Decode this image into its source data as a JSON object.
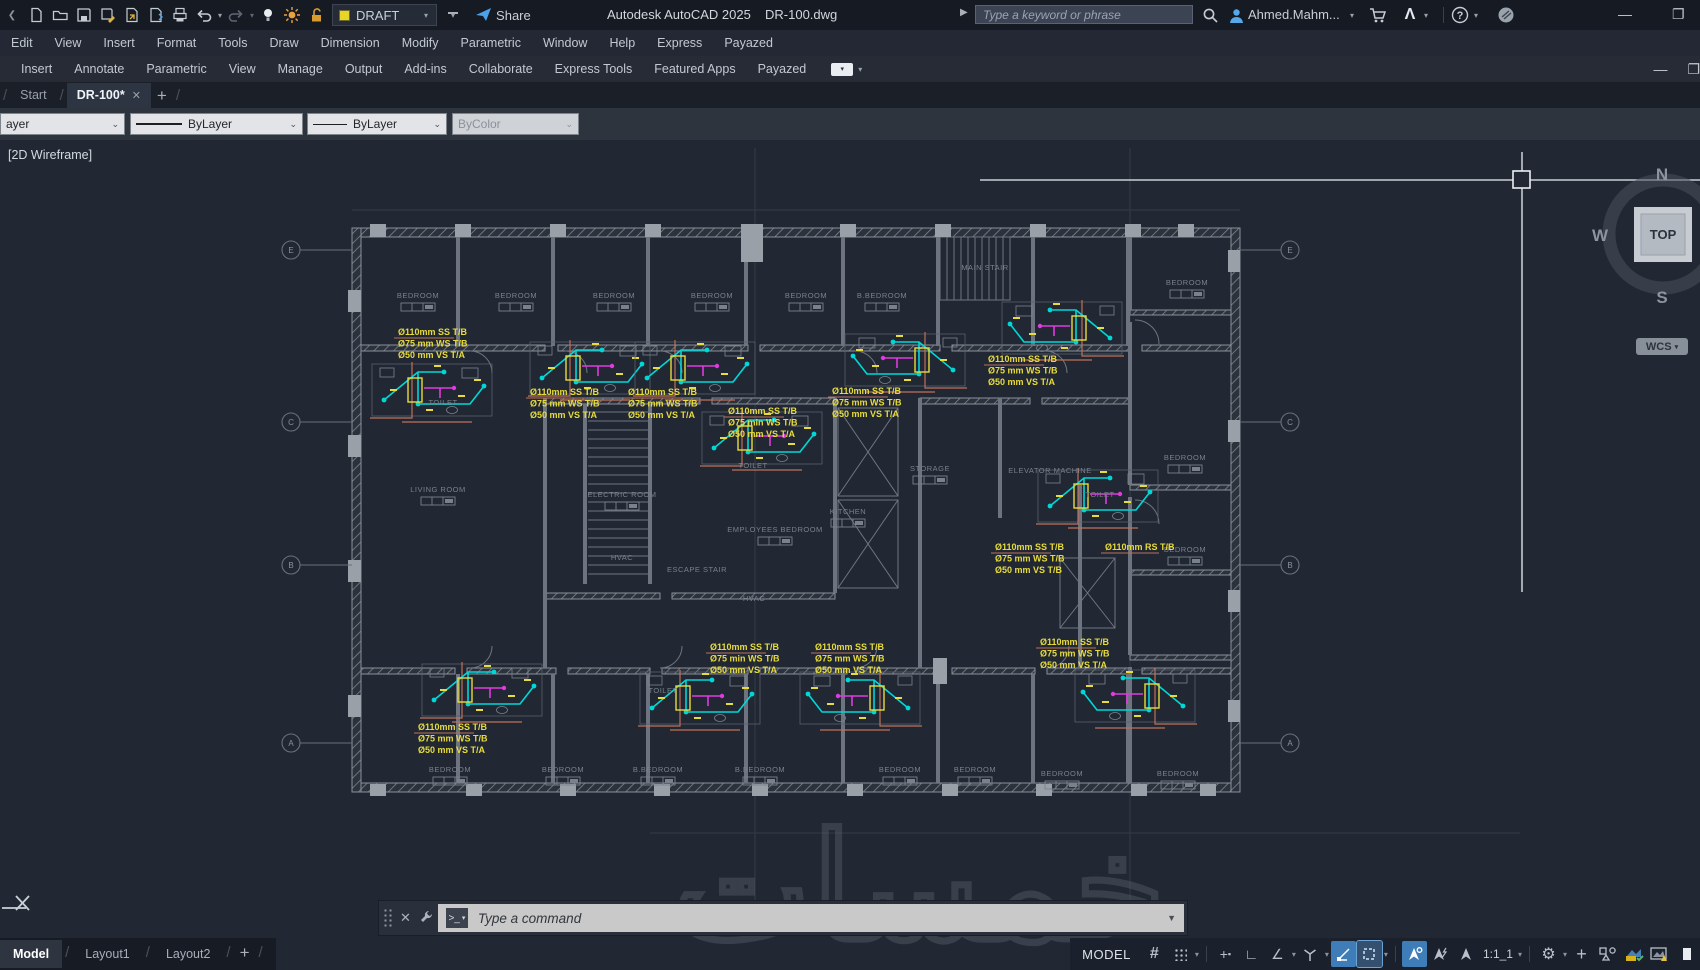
{
  "titlebar": {
    "workspace": "DRAFT",
    "share_label": "Share",
    "app_title": "Autodesk AutoCAD 2025",
    "doc_title": "DR-100.dwg",
    "search_placeholder": "Type a keyword or phrase",
    "username": "Ahmed.Mahm..."
  },
  "menubar": {
    "items": [
      "Edit",
      "View",
      "Insert",
      "Format",
      "Tools",
      "Draw",
      "Dimension",
      "Modify",
      "Parametric",
      "Window",
      "Help",
      "Express",
      "Payazed"
    ]
  },
  "ribbon": {
    "tabs": [
      "Insert",
      "Annotate",
      "Parametric",
      "View",
      "Manage",
      "Output",
      "Add-ins",
      "Collaborate",
      "Express Tools",
      "Featured Apps",
      "Payazed"
    ]
  },
  "file_tabs": {
    "items": [
      {
        "label": "Start",
        "active": false
      },
      {
        "label": "DR-100*",
        "active": true
      }
    ]
  },
  "properties_bar": {
    "layer_value": "ayer",
    "linetype_value": "ByLayer",
    "lineweight_value": "ByLayer",
    "color_value": "ByColor"
  },
  "viewport": {
    "visual_style": "[2D Wireframe]",
    "viewcube": {
      "north": "N",
      "west": "W",
      "south": "S",
      "face": "TOP",
      "wcs": "WCS"
    }
  },
  "command_line": {
    "placeholder": "Type a command"
  },
  "watermark_text": "خمسات",
  "status_bar": {
    "model_space_label": "MODEL",
    "annotation_scale": "1:1_1",
    "model_tab": "Model",
    "layout_tabs": [
      "Layout1",
      "Layout2"
    ]
  },
  "colors": {
    "canvas_bg": "#212833",
    "annotation_yellow": "#e8dc3c",
    "pipe_cyan": "#00d8d8",
    "pipe_magenta": "#e03ae0",
    "pipe_salmon": "#c0705a",
    "active_blue": "#3f7db8",
    "wall_gray": "#8a919b"
  },
  "plan": {
    "rooms": [
      {
        "label": "BEDROOM",
        "x": 418,
        "y": 158
      },
      {
        "label": "BEDROOM",
        "x": 516,
        "y": 158
      },
      {
        "label": "BEDROOM",
        "x": 614,
        "y": 158
      },
      {
        "label": "BEDROOM",
        "x": 712,
        "y": 158
      },
      {
        "label": "BEDROOM",
        "x": 806,
        "y": 158
      },
      {
        "label": "B.BEDROOM",
        "x": 882,
        "y": 158
      },
      {
        "label": "MAIN STAIR",
        "x": 985,
        "y": 130
      },
      {
        "label": "BEDROOM",
        "x": 1187,
        "y": 145
      },
      {
        "label": "TOILET",
        "x": 443,
        "y": 265
      },
      {
        "label": "TOILET",
        "x": 753,
        "y": 328
      },
      {
        "label": "TOILET",
        "x": 1100,
        "y": 357
      },
      {
        "label": "TOILET",
        "x": 663,
        "y": 553
      },
      {
        "label": "LIVING ROOM",
        "x": 438,
        "y": 352
      },
      {
        "label": "ELECTRIC ROOM",
        "x": 622,
        "y": 357
      },
      {
        "label": "HVAC",
        "x": 622,
        "y": 420
      },
      {
        "label": "ESCAPE STAIR",
        "x": 697,
        "y": 432
      },
      {
        "label": "EMPLOYEES BEDROOM",
        "x": 775,
        "y": 392
      },
      {
        "label": "KITCHEN",
        "x": 848,
        "y": 374
      },
      {
        "label": "HVAC",
        "x": 754,
        "y": 461
      },
      {
        "label": "STORAGE",
        "x": 930,
        "y": 331
      },
      {
        "label": "ELEVATOR MACHINE",
        "x": 1050,
        "y": 333
      },
      {
        "label": "BEDROOM",
        "x": 1185,
        "y": 320
      },
      {
        "label": "BEDROOM",
        "x": 1185,
        "y": 412
      },
      {
        "label": "BEDROOM",
        "x": 450,
        "y": 632
      },
      {
        "label": "BEDROOM",
        "x": 563,
        "y": 632
      },
      {
        "label": "B.BEDROOM",
        "x": 658,
        "y": 632
      },
      {
        "label": "B.BEDROOM",
        "x": 760,
        "y": 632
      },
      {
        "label": "BEDROOM",
        "x": 900,
        "y": 632
      },
      {
        "label": "BEDROOM",
        "x": 975,
        "y": 632
      },
      {
        "label": "BEDROOM",
        "x": 1062,
        "y": 636
      },
      {
        "label": "BEDROOM",
        "x": 1178,
        "y": 636
      }
    ],
    "annotations": [
      {
        "x": 398,
        "y": 195,
        "lines": [
          "Ø110mm SS T/B",
          "Ø75 mm WS T/B",
          "Ø50 mm VS T/A"
        ]
      },
      {
        "x": 530,
        "y": 255,
        "lines": [
          "Ø110mm SS T/B",
          "Ø75 mm WS T/B",
          "Ø50 mm VS T/A"
        ]
      },
      {
        "x": 628,
        "y": 255,
        "lines": [
          "Ø110mm SS T/B",
          "Ø75 mm WS T/B",
          "Ø50 mm VS T/A"
        ]
      },
      {
        "x": 832,
        "y": 254,
        "lines": [
          "Ø110mm SS T/B",
          "Ø75 mm WS T/B",
          "Ø50 mm VS T/A"
        ]
      },
      {
        "x": 988,
        "y": 222,
        "lines": [
          "Ø110mm SS T/B",
          "Ø75 mm WS T/B",
          "Ø50 mm VS T/A"
        ]
      },
      {
        "x": 728,
        "y": 274,
        "lines": [
          "Ø110mm SS T/B",
          "Ø75 min WS T/B",
          "Ø50 mm VS T/A"
        ]
      },
      {
        "x": 995,
        "y": 410,
        "lines": [
          "Ø110mm SS T/B",
          "Ø75 mm WS T/B",
          "Ø50 mm VS T/B"
        ]
      },
      {
        "x": 1105,
        "y": 410,
        "lines": [
          "Ø110mm RS T/B"
        ]
      },
      {
        "x": 418,
        "y": 590,
        "lines": [
          "Ø110mm SS T/B",
          "Ø75 mm WS T/B",
          "Ø50 mm VS T/A"
        ]
      },
      {
        "x": 710,
        "y": 510,
        "lines": [
          "Ø110mm SS T/B",
          "Ø75 min WS T/B",
          "Ø50 mm VS T/A"
        ]
      },
      {
        "x": 815,
        "y": 510,
        "lines": [
          "Ø110mm SS T/B",
          "Ø75 mm WS T/B",
          "Ø50 mm VS T/A"
        ]
      },
      {
        "x": 1040,
        "y": 505,
        "lines": [
          "Ø110mm SS T/B",
          "Ø75 mm WS T/B",
          "Ø50 mm VS T/A"
        ]
      }
    ],
    "grid_bubbles_left": [
      {
        "label": "E",
        "y": 110
      },
      {
        "label": "C",
        "y": 282
      },
      {
        "label": "B",
        "y": 425
      },
      {
        "label": "A",
        "y": 603
      }
    ],
    "grid_bubbles_right": [
      {
        "label": "E",
        "y": 110
      },
      {
        "label": "C",
        "y": 282
      },
      {
        "label": "B",
        "y": 425
      },
      {
        "label": "A",
        "y": 603
      }
    ],
    "clusters": [
      {
        "x": 432,
        "y": 252,
        "f": 1
      },
      {
        "x": 590,
        "y": 230,
        "f": 1
      },
      {
        "x": 695,
        "y": 230,
        "f": 1
      },
      {
        "x": 905,
        "y": 222,
        "f": -1
      },
      {
        "x": 1062,
        "y": 190,
        "f": -1
      },
      {
        "x": 762,
        "y": 300,
        "f": 1
      },
      {
        "x": 1098,
        "y": 358,
        "f": 1
      },
      {
        "x": 482,
        "y": 552,
        "f": 1
      },
      {
        "x": 700,
        "y": 560,
        "f": 1
      },
      {
        "x": 860,
        "y": 560,
        "f": -1
      },
      {
        "x": 1135,
        "y": 558,
        "f": -1
      }
    ]
  }
}
